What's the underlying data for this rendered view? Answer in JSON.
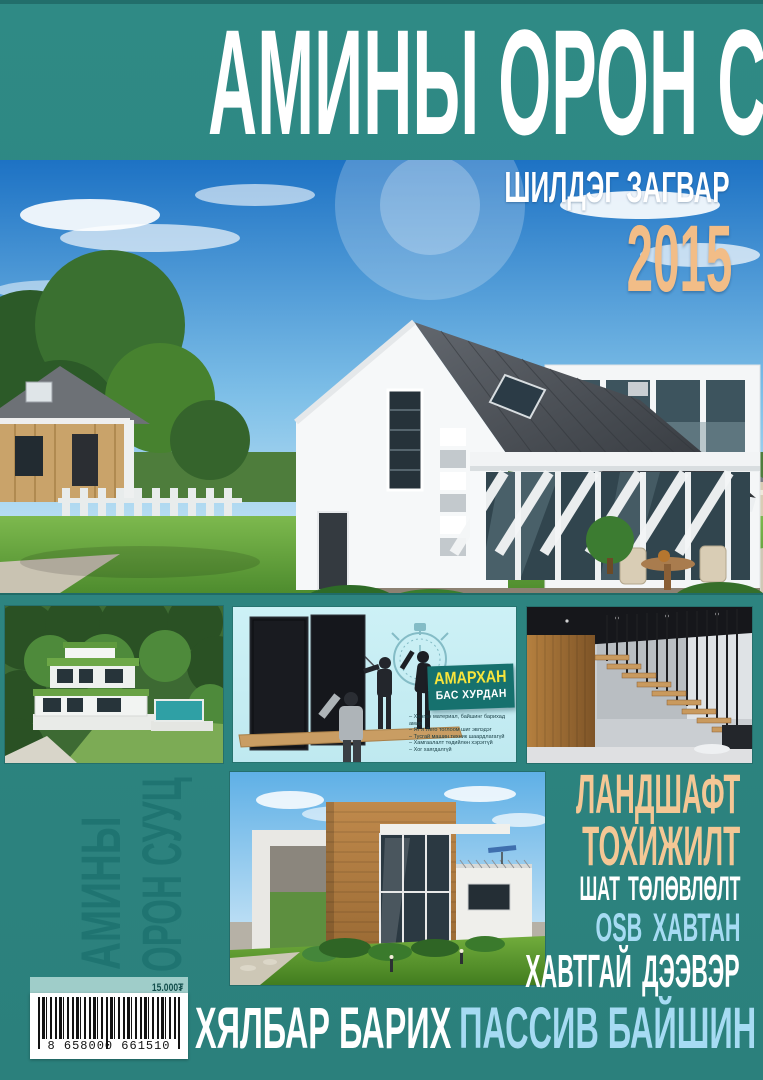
{
  "colors": {
    "background_teal": "#2e8682",
    "spine_text_teal": "#1f7471",
    "accent_peach": "#f4c795",
    "accent_light_blue": "#a6dbf3",
    "accent_yellow": "#f8e53b",
    "promo_panel_cyan": "#c6edf3",
    "promo_label_teal": "#16716e"
  },
  "masthead": {
    "title": "АМИНЫ ОРОН СУУЦ"
  },
  "hero": {
    "tagline": "ШИЛДЭГ ЗАГВАР",
    "year": "2015"
  },
  "promo": {
    "headline": "АМАРХАН",
    "subheadline": "БАС ХУРДАН",
    "bullets": [
      "Хөнгөн материал, байшинг барихад амар",
      "Яг л Лего тоглоом шиг эвлэдэг",
      "Тусгай машин техник шаардлагагүй",
      "Хамгаалалт төдийлөн хэрэггүй",
      "Хог хаягдалгүй"
    ]
  },
  "spine": {
    "line1": "АМИНЫ",
    "line2": "ОРОН СУУЦ"
  },
  "features": {
    "items": [
      {
        "label": "ЛАНДШАФТ"
      },
      {
        "label": "ТОХИЖИЛТ"
      },
      {
        "label": "ШАТ ТӨЛӨВЛӨЛТ"
      },
      {
        "label": "OSB ХАВТАН"
      },
      {
        "label": "ХАВТГАЙ ДЭЭВЭР"
      }
    ]
  },
  "footer": {
    "part_white": "ХЯЛБАР БАРИХ",
    "part_blue": "ПАССИВ БАЙШИН"
  },
  "barcode": {
    "price": "15.000₮",
    "digits": "8 658000 661510"
  }
}
